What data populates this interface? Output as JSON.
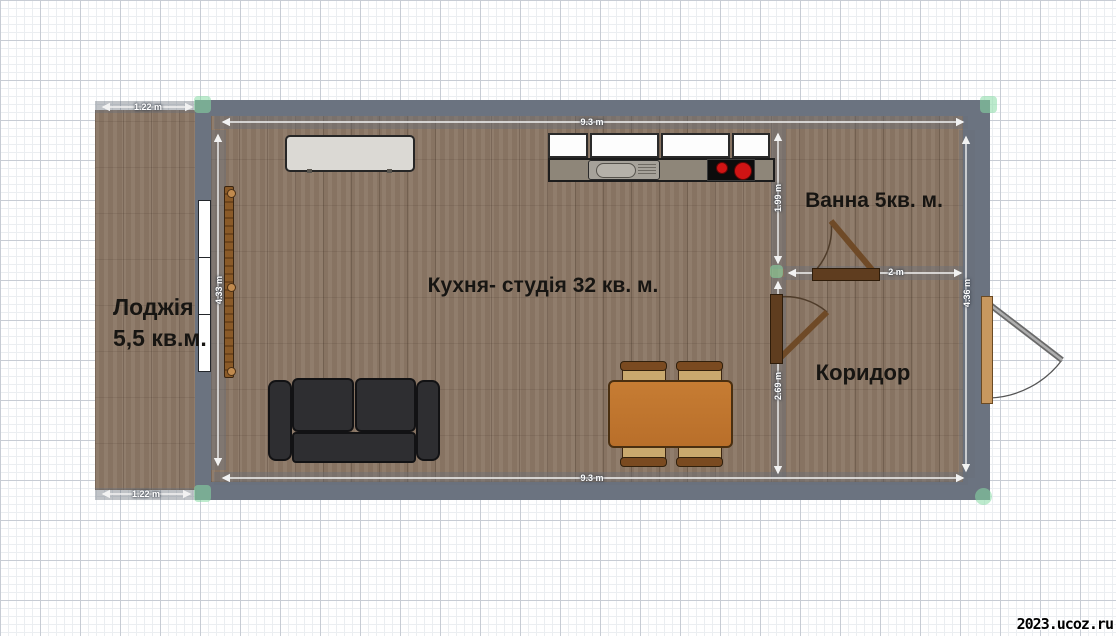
{
  "app": {
    "type": "floor-plan-editor",
    "watermark": "2023.ucoz.ru"
  },
  "rooms": {
    "loggia": {
      "label_line1": "Лоджія",
      "label_line2": "5,5 кв.м."
    },
    "kitchen": {
      "label": "Кухня- студія 32 кв. м."
    },
    "bathroom": {
      "label": "Ванна 5кв. м."
    },
    "corridor": {
      "label": "Коридор"
    }
  },
  "dimensions": {
    "loggia_top": "1.22 m",
    "loggia_bottom": "1.22 m",
    "room_top": "9.3 m",
    "room_bottom": "9.3 m",
    "room_left_height": "4.33 m",
    "room_right_height": "4.36 m",
    "bathroom_height": "1.99 m",
    "corridor_height": "2.69 m",
    "bathroom_width": "2 m"
  },
  "objects": [
    "sideboard",
    "wall-cabinets",
    "kitchen-counter",
    "sink",
    "cooktop",
    "radiator",
    "window",
    "sofa",
    "dining-table",
    "chairs",
    "bathroom-door",
    "corridor-door",
    "entrance-door",
    "corner-handles"
  ],
  "colors": {
    "wall": "#6b7380",
    "floor_wood": "#8c7866",
    "sofa": "#2e2e31",
    "table": "#c0762f",
    "chair_seat": "#c9a96e",
    "chair_back": "#7a4a20",
    "door_wood": "#5f3d1f",
    "entrance_frame": "#c8985f",
    "burner_red": "#d01414",
    "cabinet_white": "#fdfdfd",
    "counter": "#8e8679",
    "sideboard": "#dbd9d4",
    "handle_green": "#86dba4",
    "dimension_text": "#ffffff",
    "label_text": "#171512"
  }
}
